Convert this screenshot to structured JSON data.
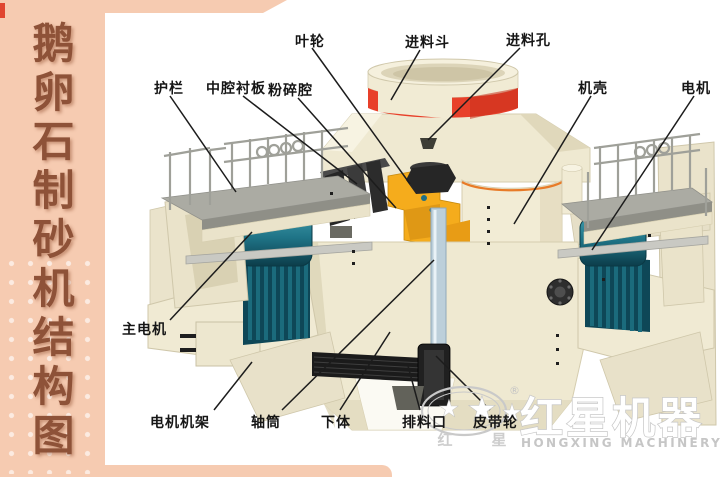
{
  "banner": {
    "title": "鹅卵石制砂机结构图"
  },
  "diagram_labels": {
    "impeller": "叶轮",
    "feed_hopper": "进料斗",
    "feed_hole": "进料孔",
    "guardrail": "护栏",
    "cavity_liner": "中腔衬板",
    "crushing_chamber": "粉碎腔",
    "casing": "机壳",
    "motor": "电机",
    "main_motor": "主电机",
    "motor_frame": "电机机架",
    "shaft_tube": "轴筒",
    "lower_body": "下体",
    "discharge_port": "排料口",
    "belt_pulley": "皮带轮"
  },
  "logo": {
    "cn": "红星机器",
    "en": "HONGXING MACHINERY",
    "seal_left": "红",
    "seal_right": "星",
    "registered": "®",
    "star": "★"
  },
  "colors": {
    "banner_bg": "#F6CBB1",
    "banner_text": "#8E5238",
    "machine_body": "#EFE9D1",
    "accent_red": "#E8402A",
    "accent_orange": "#E87B28",
    "accent_yellow": "#F5AC1C",
    "motor_teal": "#1F7487",
    "label_text": "#161616",
    "logo_gray": "#C9C9C9"
  }
}
